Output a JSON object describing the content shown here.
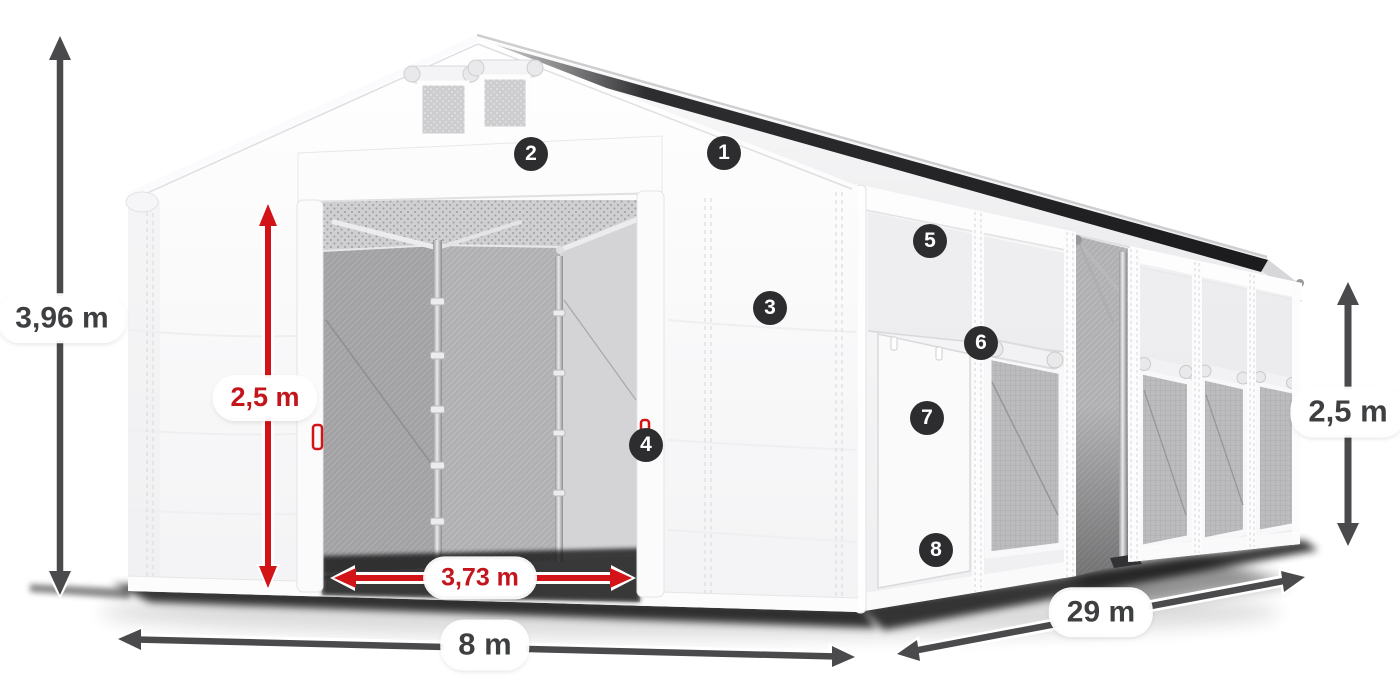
{
  "dimensions": {
    "overall_height": "3,96 m",
    "entrance_height": "2,5 m",
    "entrance_width": "3,73 m",
    "span_width": "8 m",
    "length": "29 m",
    "side_wall_height": "2,5 m"
  },
  "markers": [
    {
      "label": "1"
    },
    {
      "label": "2"
    },
    {
      "label": "3"
    },
    {
      "label": "4"
    },
    {
      "label": "5"
    },
    {
      "label": "6"
    },
    {
      "label": "7"
    },
    {
      "label": "8"
    }
  ],
  "colors": {
    "dimension_red": "#d21317",
    "dimension_red_text": "#c3151b",
    "dimension_gray": "#4a4a4c",
    "label_text": "#3e3f41",
    "marker_bg": "#2d2d2f",
    "marker_text": "#ffffff"
  }
}
